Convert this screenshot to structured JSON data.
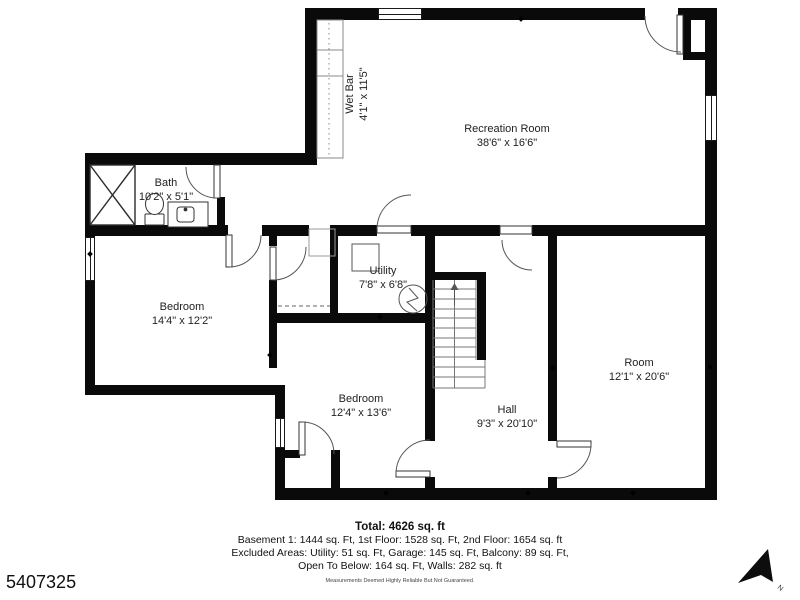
{
  "plan": {
    "id": "5407325",
    "north_label": "N"
  },
  "rooms": {
    "wet_bar": {
      "name": "Wet Bar",
      "dims": "4'1\" x 11'5\""
    },
    "recreation": {
      "name": "Recreation Room",
      "dims": "38'6\" x 16'6\""
    },
    "bath": {
      "name": "Bath",
      "dims": "10'2\" x 5'1\""
    },
    "bedroom_left": {
      "name": "Bedroom",
      "dims": "14'4\" x 12'2\""
    },
    "utility": {
      "name": "Utility",
      "dims": "7'8\" x 6'8\""
    },
    "bedroom_bottom": {
      "name": "Bedroom",
      "dims": "12'4\" x 13'6\""
    },
    "hall": {
      "name": "Hall",
      "dims": "9'3\" x 20'10\""
    },
    "room": {
      "name": "Room",
      "dims": "12'1\" x 20'6\""
    }
  },
  "footer": {
    "total": "Total: 4626 sq. ft",
    "line1": "Basement 1: 1444 sq. Ft, 1st Floor: 1528 sq. Ft, 2nd Floor: 1654 sq. ft",
    "line2": "Excluded Areas: Utility: 51 sq. Ft, Garage: 145 sq. Ft, Balcony: 89 sq. Ft,",
    "line3": "Open To Below: 164 sq. Ft, Walls: 282 sq. ft",
    "disclaimer": "Measurements Deemed Highly Reliable But Not Guaranteed."
  },
  "colors": {
    "wall": "#0a0a0a",
    "text": "#222222",
    "fixture_stroke": "#555555"
  }
}
